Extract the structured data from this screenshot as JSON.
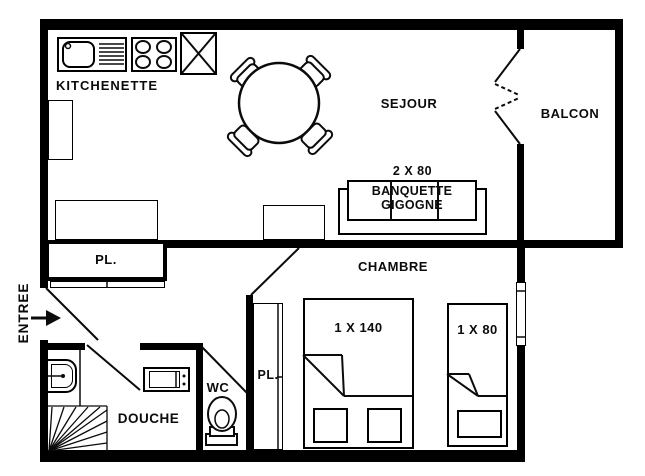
{
  "plan": {
    "title": "apartment floor plan",
    "rooms": {
      "kitchenette": {
        "label": "KITCHENETTE"
      },
      "sejour": {
        "label": "SEJOUR"
      },
      "balcon": {
        "label": "BALCON"
      },
      "chambre": {
        "label": "CHAMBRE"
      },
      "douche": {
        "label": "DOUCHE"
      },
      "wc": {
        "label": "WC"
      },
      "entree": {
        "label": "ENTREE"
      }
    },
    "furniture": {
      "banquette": {
        "size": "2 X 80",
        "line1": "BANQUETTE",
        "line2": "GIGOGNE"
      },
      "closet_hall": {
        "label": "PL."
      },
      "closet_corridor": {
        "label": "PL."
      },
      "bed_double": {
        "label": "1 X 140"
      },
      "bed_single": {
        "label": "1 X 80"
      }
    },
    "colors": {
      "line": "#000000",
      "background": "#ffffff"
    }
  }
}
